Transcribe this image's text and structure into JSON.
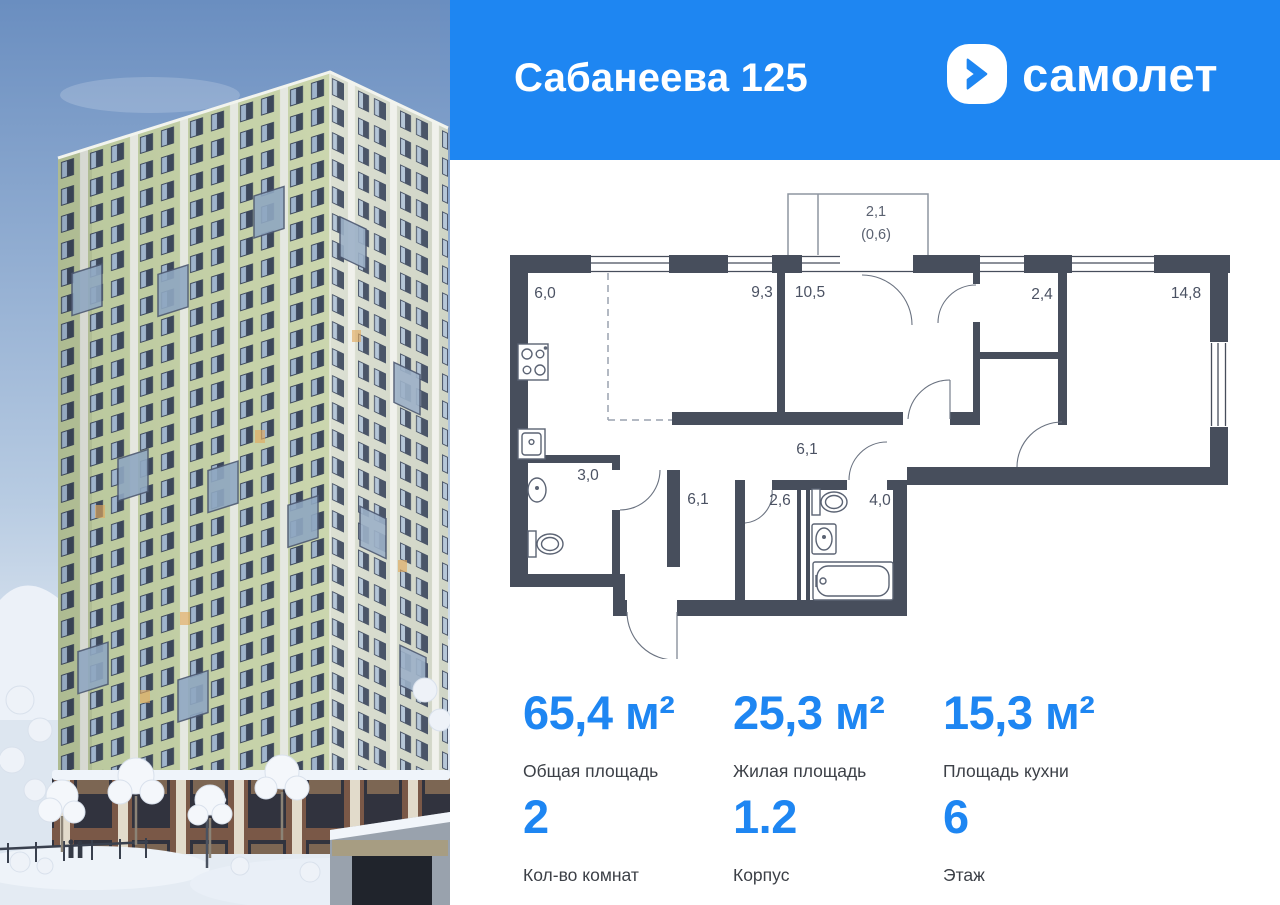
{
  "header": {
    "title": "Сабанеева 125",
    "logo_text": "самолет"
  },
  "colors": {
    "brand_blue": "#1E86F2",
    "plan_wall": "#474E5C",
    "plan_text": "#4B5263",
    "facade_green": "#C5D1A8"
  },
  "floor_plan": {
    "balcony_area": "2,1",
    "balcony_area_reduced": "(0,6)",
    "rooms": [
      {
        "name": "kitchen",
        "area": "6,0"
      },
      {
        "name": "living-room",
        "area": "9,3"
      },
      {
        "name": "bedroom",
        "area": "10,5"
      },
      {
        "name": "wardrobe",
        "area": "2,4"
      },
      {
        "name": "bedroom-2",
        "area": "14,8"
      },
      {
        "name": "corridor",
        "area": "6,1"
      },
      {
        "name": "wc",
        "area": "3,0"
      },
      {
        "name": "hallway",
        "area": "6,1"
      },
      {
        "name": "storage",
        "area": "2,6"
      },
      {
        "name": "bathroom",
        "area": "4,0"
      }
    ]
  },
  "stats": {
    "primary": [
      {
        "value": "65,4 м²",
        "label": "Общая площадь"
      },
      {
        "value": "25,3 м²",
        "label": "Жилая площадь"
      },
      {
        "value": "15,3 м²",
        "label": "Площадь кухни"
      }
    ],
    "secondary": [
      {
        "value": "2",
        "label": "Кол-во комнат"
      },
      {
        "value": "1.2",
        "label": "Корпус"
      },
      {
        "value": "6",
        "label": "Этаж"
      }
    ]
  }
}
